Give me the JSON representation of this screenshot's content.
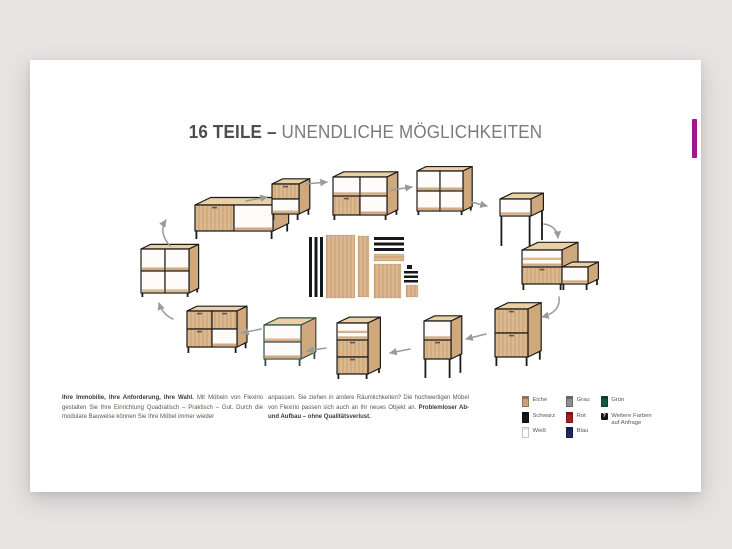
{
  "page": {
    "background": "#e5e4e3"
  },
  "card": {
    "accent_tab_color": "#a0148d"
  },
  "title": {
    "strong": "16 TEILE –",
    "light": " UNENDLICHE MÖGLICHKEITEN"
  },
  "paragraphs": {
    "left_bold": "Ihre Immobilie, Ihre Anforderung, Ihre Wahl.",
    "left_rest": " Mit Möbeln von Flexirio gestalten Sie Ihre Einrichtung Quadratisch – Praktisch – Gut. Durch die modulare Bauweise können Sie Ihre Möbel immer wieder",
    "right_rest": "anpassen. Sie ziehen in andere Räumlichkeiten? Die hochwertigen Möbel von Flexirio passen sich auch an Ihr neues Objekt an. ",
    "right_bold": "Problemloser Ab- und Aufbau – ohne Qualitätsverlust."
  },
  "legend": {
    "columns": [
      {
        "items": [
          {
            "label": "Eiche",
            "color": "#c8a178"
          },
          {
            "label": "Schwarz",
            "color": "#161616"
          },
          {
            "label": "Weiß",
            "color": "#ffffff"
          }
        ]
      },
      {
        "items": [
          {
            "label": "Grau",
            "color": "#8f8f8f"
          },
          {
            "label": "Rot",
            "color": "#a32222"
          },
          {
            "label": "Blau",
            "color": "#1d2a60"
          }
        ]
      },
      {
        "items": [
          {
            "label": "Grün",
            "color": "#0e5a3c"
          },
          {
            "label": "Weitere Farben auf Anfrage",
            "icon": "question"
          }
        ]
      }
    ]
  },
  "illustration": {
    "colors": {
      "frame": "#1d1b18",
      "frameGreen": "#2e4f41",
      "wood": "#d9b48a",
      "woodTop": "#e9d0a6",
      "woodSide": "#cfa97c",
      "arrow": "#9a9a98",
      "black": "#181818"
    },
    "furniture": [
      {
        "name": "furniture-sideboard-low",
        "x": 165,
        "y": 145,
        "boxes": [
          {
            "cols": 2,
            "rows": 1,
            "cw": 39,
            "ch": 26,
            "cells": [
              "do"
            ],
            "legH": 8
          }
        ]
      },
      {
        "name": "furniture-cabinet-flap",
        "x": 242,
        "y": 124,
        "boxes": [
          {
            "cols": 1,
            "rows": 2,
            "cw": 27,
            "ch": 15,
            "cells": [
              "d",
              "o"
            ],
            "legH": 6
          }
        ]
      },
      {
        "name": "furniture-shelf-wide",
        "x": 303,
        "y": 117,
        "boxes": [
          {
            "cols": 2,
            "rows": 2,
            "cw": 27,
            "ch": 19,
            "cells": [
              "oo",
              "do"
            ],
            "legH": 5
          }
        ]
      },
      {
        "name": "furniture-bookcase-right",
        "x": 387,
        "y": 111,
        "boxes": [
          {
            "cols": 2,
            "rows": 2,
            "cw": 23,
            "ch": 20,
            "cells": [
              "oo",
              "oo"
            ],
            "legH": 4
          }
        ]
      },
      {
        "name": "furniture-side-table",
        "x": 470,
        "y": 139,
        "boxes": [
          {
            "cols": 1,
            "rows": 1,
            "cw": 31,
            "ch": 17,
            "cells": [
              "o"
            ],
            "legH": 30
          }
        ]
      },
      {
        "name": "furniture-sideboard-stepped",
        "x": 492,
        "y": 190,
        "boxes": [
          {
            "cols": 1,
            "rows": 2,
            "cw": 40,
            "ch": 17,
            "cells": [
              "s",
              "d"
            ],
            "legH": 6
          },
          {
            "ox": 40,
            "oy": 17,
            "cols": 1,
            "rows": 1,
            "cw": 26,
            "ch": 17,
            "cells": [
              "o"
            ],
            "legH": 6
          }
        ]
      },
      {
        "name": "furniture-cabinet-two-flaps",
        "x": 465,
        "y": 249,
        "boxes": [
          {
            "cols": 1,
            "rows": 2,
            "cw": 33,
            "ch": 24,
            "cells": [
              "d",
              "d"
            ],
            "legH": 9
          }
        ]
      },
      {
        "name": "furniture-cabinet-secretary",
        "x": 394,
        "y": 261,
        "boxes": [
          {
            "cols": 1,
            "rows": 2,
            "cw": 27,
            "ch": 19,
            "cells": [
              "o",
              "d"
            ],
            "legH": 19
          }
        ]
      },
      {
        "name": "furniture-cabinet-drawers-tall",
        "x": 307,
        "y": 263,
        "boxes": [
          {
            "cols": 1,
            "rows": 3,
            "cw": 31,
            "ch": 17,
            "cells": [
              "s",
              "d",
              "d"
            ],
            "legH": 5
          }
        ]
      },
      {
        "name": "furniture-shelf-green",
        "x": 234,
        "y": 265,
        "frame": "green",
        "boxes": [
          {
            "cols": 1,
            "rows": 2,
            "cw": 37,
            "ch": 17,
            "cells": [
              "o",
              "o"
            ],
            "legH": 7
          }
        ]
      },
      {
        "name": "furniture-sideboard-closed",
        "x": 157,
        "y": 251,
        "boxes": [
          {
            "cols": 2,
            "rows": 2,
            "cw": 25,
            "ch": 18,
            "cells": [
              "dd",
              "do"
            ],
            "legH": 6
          }
        ]
      },
      {
        "name": "furniture-bookcase-left",
        "x": 111,
        "y": 189,
        "boxes": [
          {
            "cols": 2,
            "rows": 2,
            "cw": 24,
            "ch": 22,
            "cells": [
              "oo",
              "oo"
            ],
            "legH": 4
          }
        ]
      }
    ],
    "arrows": [
      {
        "x1": 140,
        "y1": 186,
        "x2": 136,
        "y2": 160,
        "q": [
          128,
          172
        ]
      },
      {
        "x1": 216,
        "y1": 141,
        "x2": 237,
        "y2": 137
      },
      {
        "x1": 276,
        "y1": 124,
        "x2": 297,
        "y2": 122
      },
      {
        "x1": 361,
        "y1": 130,
        "x2": 382,
        "y2": 127
      },
      {
        "x1": 441,
        "y1": 142,
        "x2": 457,
        "y2": 146
      },
      {
        "x1": 514,
        "y1": 164,
        "x2": 528,
        "y2": 178,
        "q": [
          527,
          166
        ]
      },
      {
        "x1": 529,
        "y1": 237,
        "x2": 512,
        "y2": 257,
        "q": [
          531,
          252
        ]
      },
      {
        "x1": 456,
        "y1": 274,
        "x2": 436,
        "y2": 279
      },
      {
        "x1": 380,
        "y1": 289,
        "x2": 360,
        "y2": 293
      },
      {
        "x1": 296,
        "y1": 288,
        "x2": 277,
        "y2": 291
      },
      {
        "x1": 231,
        "y1": 269,
        "x2": 212,
        "y2": 273
      },
      {
        "x1": 143,
        "y1": 259,
        "x2": 129,
        "y2": 243,
        "q": [
          133,
          255
        ]
      }
    ],
    "parts": [
      {
        "x": 279,
        "y": 177,
        "w": 3,
        "h": 60,
        "f": "black"
      },
      {
        "x": 284.5,
        "y": 177,
        "w": 3,
        "h": 60,
        "f": "black"
      },
      {
        "x": 290,
        "y": 177,
        "w": 3,
        "h": 60,
        "f": "black"
      },
      {
        "x": 296,
        "y": 175,
        "w": 29,
        "h": 63,
        "f": "woodV"
      },
      {
        "x": 328,
        "y": 176,
        "w": 11,
        "h": 61,
        "f": "woodV"
      },
      {
        "x": 344,
        "y": 177,
        "w": 30,
        "h": 3,
        "f": "black"
      },
      {
        "x": 344,
        "y": 182.5,
        "w": 30,
        "h": 3,
        "f": "black"
      },
      {
        "x": 344,
        "y": 188,
        "w": 30,
        "h": 3,
        "f": "black"
      },
      {
        "x": 344,
        "y": 194,
        "w": 30,
        "h": 7,
        "f": "woodH"
      },
      {
        "x": 344,
        "y": 204,
        "w": 27,
        "h": 34,
        "f": "woodV"
      },
      {
        "x": 377,
        "y": 205,
        "w": 5,
        "h": 4,
        "f": "black"
      },
      {
        "x": 374,
        "y": 211,
        "w": 14,
        "h": 2.5,
        "f": "black"
      },
      {
        "x": 374,
        "y": 215.5,
        "w": 14,
        "h": 2.5,
        "f": "black"
      },
      {
        "x": 374,
        "y": 220,
        "w": 14,
        "h": 2.5,
        "f": "black"
      },
      {
        "x": 376,
        "y": 225,
        "w": 12,
        "h": 12,
        "f": "woodV"
      }
    ]
  }
}
